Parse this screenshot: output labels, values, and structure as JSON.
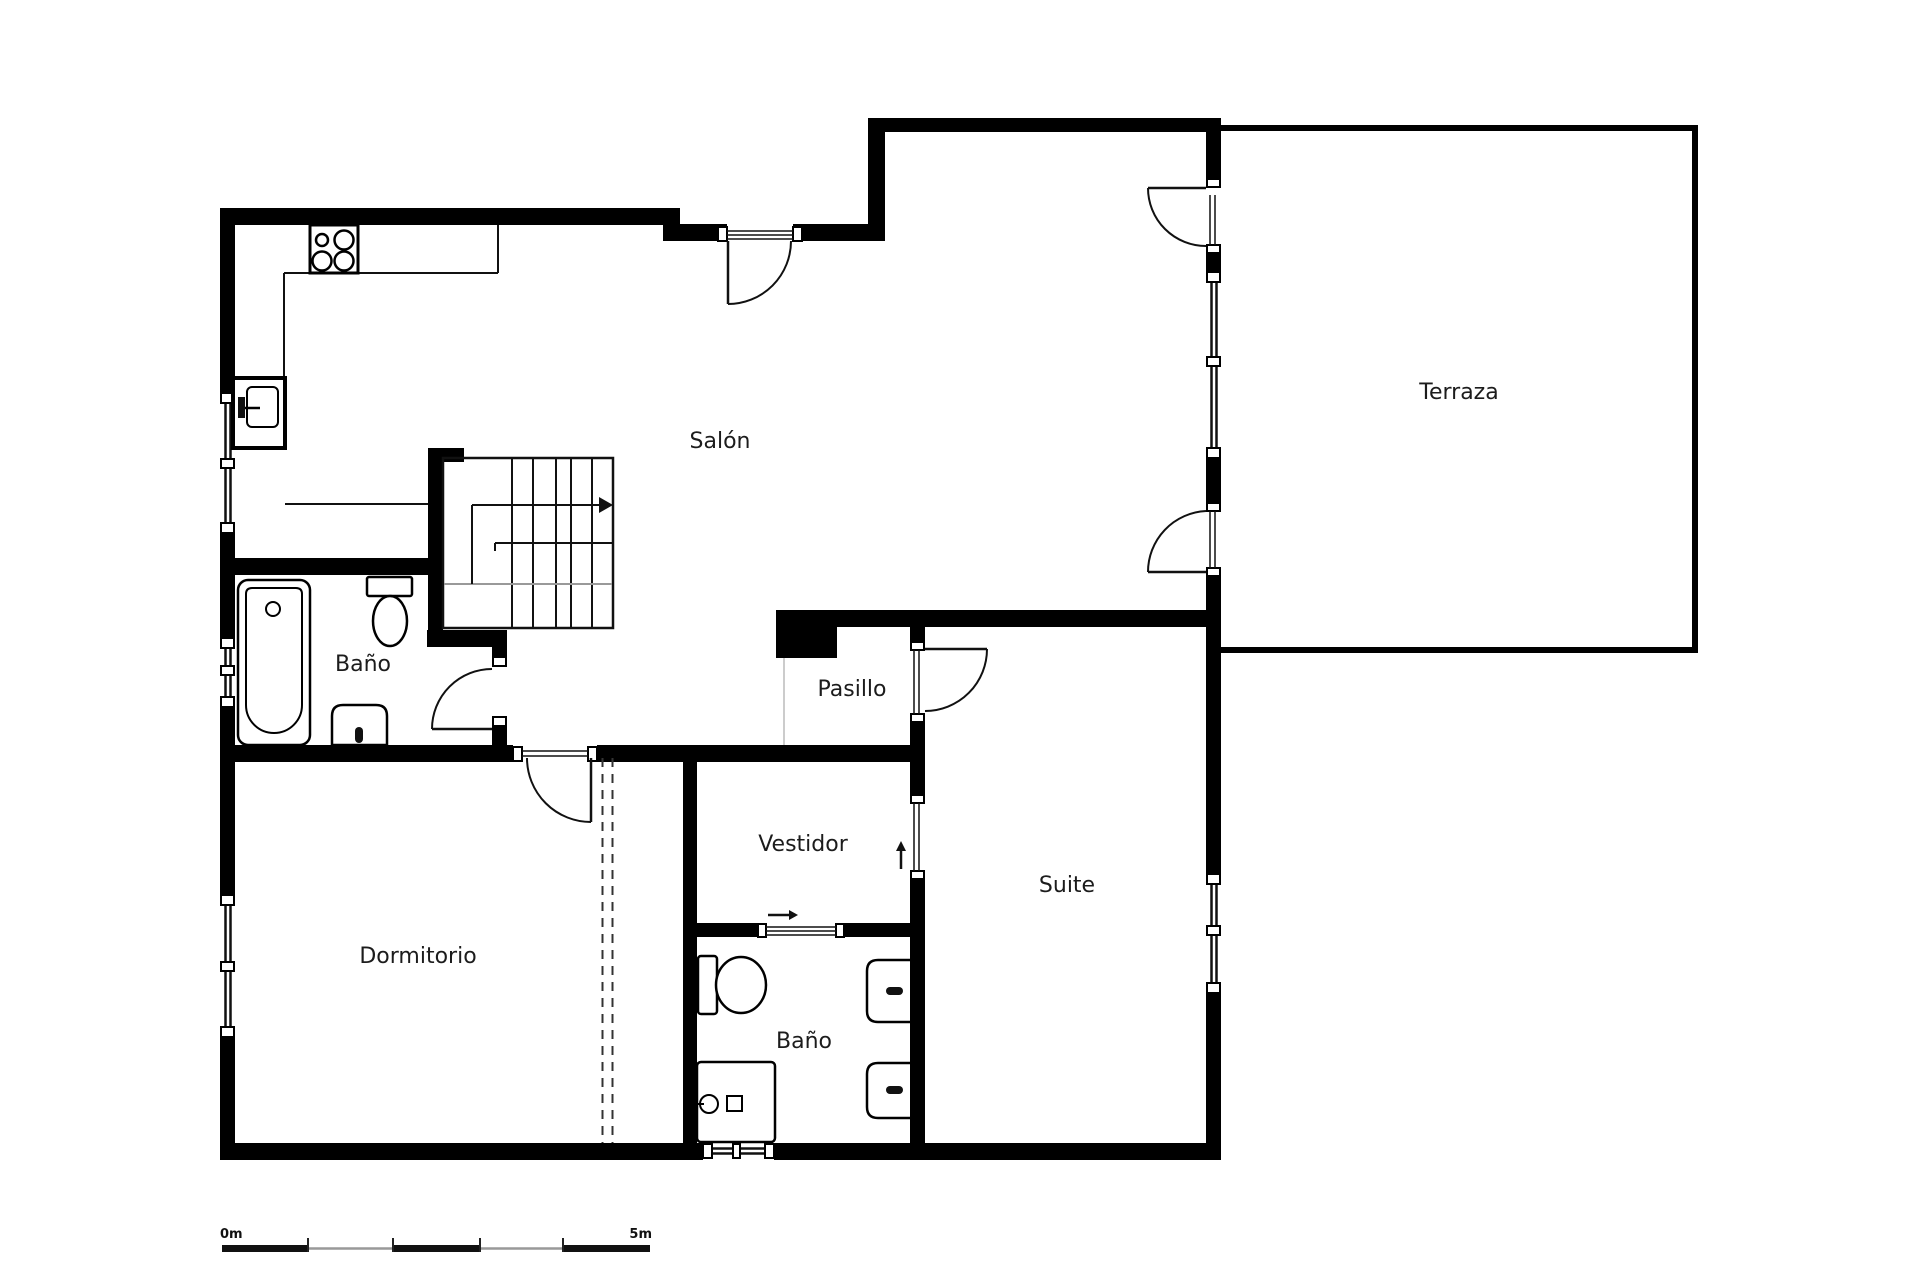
{
  "plan": {
    "type": "floor-plan",
    "units": "meters",
    "rooms": [
      {
        "id": "salon",
        "label": "Salón",
        "x": 720,
        "y": 442
      },
      {
        "id": "terraza",
        "label": "Terraza",
        "x": 1459,
        "y": 393
      },
      {
        "id": "bano-sup",
        "label": "Baño",
        "x": 363,
        "y": 665
      },
      {
        "id": "pasillo",
        "label": "Pasillo",
        "x": 852,
        "y": 690
      },
      {
        "id": "vestidor",
        "label": "Vestidor",
        "x": 803,
        "y": 845
      },
      {
        "id": "suite",
        "label": "Suite",
        "x": 1067,
        "y": 886
      },
      {
        "id": "dormitorio",
        "label": "Dormitorio",
        "x": 418,
        "y": 957
      },
      {
        "id": "bano-inf",
        "label": "Baño",
        "x": 804,
        "y": 1042
      }
    ],
    "colors": {
      "wall": "#000000",
      "line": "#111111",
      "label": "#1c1c1c",
      "gray": "#999999",
      "dash": "#333333",
      "helper": "#bbbbbb",
      "white": "#ffffff",
      "fill_dark": "#111111"
    },
    "scale_bar": {
      "label_start": "0m",
      "label_end": "5m",
      "x0": 222,
      "x1": 650,
      "y": 1248.5,
      "label_y": 1238,
      "thick_segments": [
        [
          222,
          86
        ],
        [
          393,
          87
        ],
        [
          563,
          87
        ]
      ],
      "thin_segments": [
        [
          308,
          85
        ],
        [
          480,
          83
        ]
      ],
      "ticks": [
        308,
        393,
        480,
        563
      ]
    },
    "geometry": {
      "wall_rects": [
        [
          "outer-left-1",
          220,
          208,
          15,
          185
        ],
        [
          "outer-left-2",
          220,
          533,
          15,
          105
        ],
        [
          "outer-left-3",
          220,
          707,
          15,
          188
        ],
        [
          "outer-left-4",
          220,
          1037,
          15,
          123
        ],
        [
          "top-wall-a",
          220,
          208,
          460,
          17
        ],
        [
          "top-wall-step",
          663,
          224,
          64,
          17
        ],
        [
          "top-wall-b2",
          793,
          224,
          92,
          17
        ],
        [
          "top-wall-riser",
          868,
          118,
          17,
          123
        ],
        [
          "top-wall-d",
          868,
          118,
          353,
          14
        ],
        [
          "salon-terraza-col-1",
          1206,
          118,
          15,
          69
        ],
        [
          "salon-terraza-col-2",
          1206,
          253,
          15,
          19
        ],
        [
          "salon-terraza-col-3",
          1206,
          458,
          15,
          45
        ],
        [
          "salon-terraza-col-4",
          1206,
          577,
          15,
          297
        ],
        [
          "salon-terraza-col-5",
          1206,
          993,
          15,
          167
        ],
        [
          "salon-suite-divider",
          776,
          610,
          445,
          17
        ],
        [
          "pasillo-pillar",
          776,
          610,
          61,
          48
        ],
        [
          "suite-left-1",
          910,
          627,
          15,
          15
        ],
        [
          "suite-left-2",
          910,
          723,
          15,
          72
        ],
        [
          "suite-left-3",
          910,
          880,
          15,
          280
        ],
        [
          "corridor-wall-1",
          235,
          745,
          278,
          17
        ],
        [
          "corridor-wall-2",
          597,
          745,
          328,
          17
        ],
        [
          "vestidor-left",
          683,
          745,
          14,
          415
        ],
        [
          "vestidor-bano-1",
          697,
          923,
          61,
          14
        ],
        [
          "vestidor-bano-2",
          845,
          923,
          80,
          14
        ],
        [
          "bano-sup-top",
          235,
          558,
          208,
          17
        ],
        [
          "bano-sup-right-1",
          492,
          634,
          15,
          23
        ],
        [
          "bano-sup-right-2",
          492,
          727,
          15,
          35
        ],
        [
          "stairs-wall",
          428,
          448,
          15,
          199
        ],
        [
          "stairs-cap",
          443,
          448,
          21,
          14
        ],
        [
          "stairs-stub",
          427,
          630,
          80,
          17
        ],
        [
          "bottom-wall-1",
          220,
          1143,
          483,
          17
        ],
        [
          "bottom-wall-2",
          774,
          1143,
          447,
          17
        ],
        [
          "terraza-top",
          1221,
          125,
          477,
          6
        ],
        [
          "terraza-right",
          1692,
          125,
          6,
          528
        ],
        [
          "terraza-bottom",
          1221,
          647,
          477,
          6
        ]
      ],
      "windows": [
        {
          "name": "window-kitchen",
          "o": "v",
          "x": 221,
          "w": 13,
          "y0": 393,
          "y1": 533,
          "mid": 463,
          "p": [
            225.5,
            230.5
          ]
        },
        {
          "name": "window-bano-sup",
          "o": "v",
          "x": 221,
          "w": 13,
          "y0": 638,
          "y1": 707,
          "mid": 670,
          "p": [
            225.5,
            230.5
          ]
        },
        {
          "name": "window-dormitorio",
          "o": "v",
          "x": 221,
          "w": 13,
          "y0": 895,
          "y1": 1037,
          "mid": 966,
          "p": [
            225.5,
            230.5
          ]
        },
        {
          "name": "window-terraza-wall",
          "o": "v",
          "x": 1207,
          "w": 13,
          "y0": 272,
          "y1": 458,
          "mid": 361,
          "p": [
            1211.5,
            1216.5
          ]
        },
        {
          "name": "window-suite",
          "o": "v",
          "x": 1207,
          "w": 13,
          "y0": 874,
          "y1": 993,
          "mid": 930,
          "p": [
            1211.5,
            1216.5
          ]
        },
        {
          "name": "window-bano-inf",
          "o": "h",
          "y": 1144,
          "h": 14,
          "x0": 703,
          "x1": 774,
          "mid": 736,
          "p": [
            1148.5,
            1153.5
          ]
        }
      ],
      "doors": [
        {
          "name": "door-salon-entry",
          "leaf": [
            728,
            241,
            728,
            304
          ],
          "arc": "M791,241 A63,63 0 0 1 728,304"
        },
        {
          "name": "door-bano-sup",
          "leaf": [
            432,
            729,
            492,
            729
          ],
          "arc": "M432,729 A60,60 0 0 1 492,669"
        },
        {
          "name": "door-dormitorio",
          "leaf": [
            591,
            758,
            591,
            822
          ],
          "arc": "M527,758 A64,64 0 0 0 591,822"
        },
        {
          "name": "door-suite",
          "leaf": [
            925,
            649,
            987,
            649
          ],
          "arc": "M987,649 A62,62 0 0 1 925,711"
        },
        {
          "name": "door-terraza-upper",
          "leaf": [
            1148,
            188,
            1206,
            188
          ],
          "arc": "M1148,188 A58,58 0 0 0 1206,246"
        },
        {
          "name": "door-terraza-lower",
          "leaf": [
            1148,
            572,
            1206,
            572
          ],
          "arc": "M1148,572 A61,61 0 0 1 1206,511"
        }
      ],
      "frame_blocks": [
        [
          718,
          227,
          9,
          14
        ],
        [
          793,
          227,
          9,
          14
        ],
        [
          513,
          747,
          9,
          14
        ],
        [
          588,
          747,
          9,
          14
        ],
        [
          493,
          657,
          13,
          9
        ],
        [
          493,
          717,
          13,
          9
        ],
        [
          911,
          642,
          13,
          8
        ],
        [
          911,
          714,
          13,
          8
        ],
        [
          911,
          795,
          13,
          8
        ],
        [
          911,
          871,
          13,
          8
        ],
        [
          758,
          924,
          8,
          13
        ],
        [
          836,
          924,
          8,
          13
        ],
        [
          1207,
          179,
          13,
          8
        ],
        [
          1207,
          245,
          13,
          8
        ],
        [
          1207,
          503,
          13,
          8
        ],
        [
          1207,
          568,
          13,
          8
        ]
      ],
      "glaze_lines": [
        [
          727,
          231,
          793,
          231
        ],
        [
          727,
          235,
          793,
          235
        ],
        [
          727,
          239,
          793,
          239
        ],
        [
          522,
          751,
          588,
          751
        ],
        [
          522,
          756,
          588,
          756
        ],
        [
          914,
          650,
          914,
          714
        ],
        [
          919,
          650,
          919,
          714
        ],
        [
          914,
          803,
          914,
          871
        ],
        [
          919,
          803,
          919,
          871
        ],
        [
          766,
          927,
          836,
          927
        ],
        [
          766,
          931,
          836,
          931
        ],
        [
          766,
          935,
          836,
          935
        ],
        [
          1210,
          195,
          1210,
          245
        ],
        [
          1215,
          195,
          1215,
          245
        ],
        [
          1210,
          511,
          1210,
          568
        ],
        [
          1215,
          511,
          1215,
          568
        ]
      ],
      "counter_lines": [
        [
          284,
          273,
          310,
          273
        ],
        [
          358,
          273,
          498,
          273
        ],
        [
          498,
          225,
          498,
          273
        ],
        [
          284,
          273,
          284,
          378
        ],
        [
          285,
          504,
          428,
          504
        ]
      ],
      "dashed_lines": [
        [
          602.5,
          758,
          602.5,
          1143
        ],
        [
          612.5,
          758,
          612.5,
          1143
        ]
      ],
      "helper_lines": [
        [
          784,
          658,
          784,
          745
        ]
      ],
      "stairs": {
        "box": [
          443,
          458,
          170,
          170
        ],
        "risers": [
          512,
          533,
          556,
          571,
          592
        ],
        "riser_y0": 459,
        "riser_y1": 627,
        "rail": [
          495,
          543,
          612,
          543
        ],
        "rail_hook": [
          495,
          543,
          495,
          551
        ],
        "gray_line": [
          444,
          584,
          612,
          584
        ],
        "inner_v": [
          472,
          505,
          472,
          584
        ],
        "arrow_line": [
          472,
          505,
          599,
          505
        ],
        "arrow_head": [
          [
            599,
            497
          ],
          [
            613,
            505
          ],
          [
            599,
            513
          ]
        ]
      },
      "arrows": [
        {
          "name": "arrow-sliding-door",
          "line": [
            768,
            915,
            789,
            915
          ],
          "head": [
            [
              789,
              910
            ],
            [
              798,
              915
            ],
            [
              789,
              920
            ]
          ]
        },
        {
          "name": "arrow-vestidor-suite",
          "line": [
            901,
            869,
            901,
            850
          ],
          "head": [
            [
              896,
              851
            ],
            [
              901,
              841
            ],
            [
              906,
              851
            ]
          ]
        }
      ],
      "fixtures": {
        "stove": {
          "box": [
            310,
            225,
            48,
            48
          ],
          "burners": [
            [
              322,
              240,
              6
            ],
            [
              344,
              240,
              9.5
            ],
            [
              322,
              261,
              9.5
            ],
            [
              344,
              261,
              9.5
            ]
          ]
        },
        "sink": {
          "box": [
            233,
            378,
            52,
            70
          ],
          "basin": [
            247,
            387,
            31,
            40
          ],
          "faucet": [
            238,
            397,
            7,
            21
          ],
          "spout": [
            245,
            408,
            260,
            408
          ]
        },
        "bathtub": {
          "outer": [
            238,
            580,
            72,
            165
          ],
          "inner": "M252,588 L296,588 Q302,588 302,594 L302,705 A28,28 0 0 1 246,705 L246,594 Q246,588 252,588 Z",
          "drain": [
            273,
            609,
            7
          ]
        },
        "toilet_sup": {
          "tank": [
            367,
            577,
            45,
            19
          ],
          "bowl": [
            390,
            621,
            17,
            25
          ]
        },
        "bidet": {
          "body": "M332,745 L332,716 Q332,705 343,705 L376,705 Q387,705 387,716 L387,745 Z",
          "pill": [
            355,
            727,
            8,
            16
          ]
        },
        "toilet_inf": {
          "tank": [
            698,
            956,
            19,
            58
          ],
          "bowl": [
            741,
            985,
            25,
            28
          ]
        },
        "shower": {
          "box": [
            697,
            1062,
            78,
            80
          ],
          "circle": [
            709,
            1104,
            9
          ],
          "tick": [
            694,
            1104,
            704,
            1104
          ],
          "square": [
            727,
            1096,
            15,
            15
          ]
        },
        "wall_units": [
          {
            "body": "M910,960 L878,960 Q867,960 867,971 L867,1011 Q867,1022 878,1022 L910,1022",
            "pill": [
              886,
              987,
              17,
              8
            ]
          },
          {
            "body": "M910,1063 L878,1063 Q867,1063 867,1074 L867,1107 Q867,1118 878,1118 L910,1118",
            "pill": [
              886,
              1086,
              17,
              8
            ]
          }
        ]
      }
    }
  }
}
